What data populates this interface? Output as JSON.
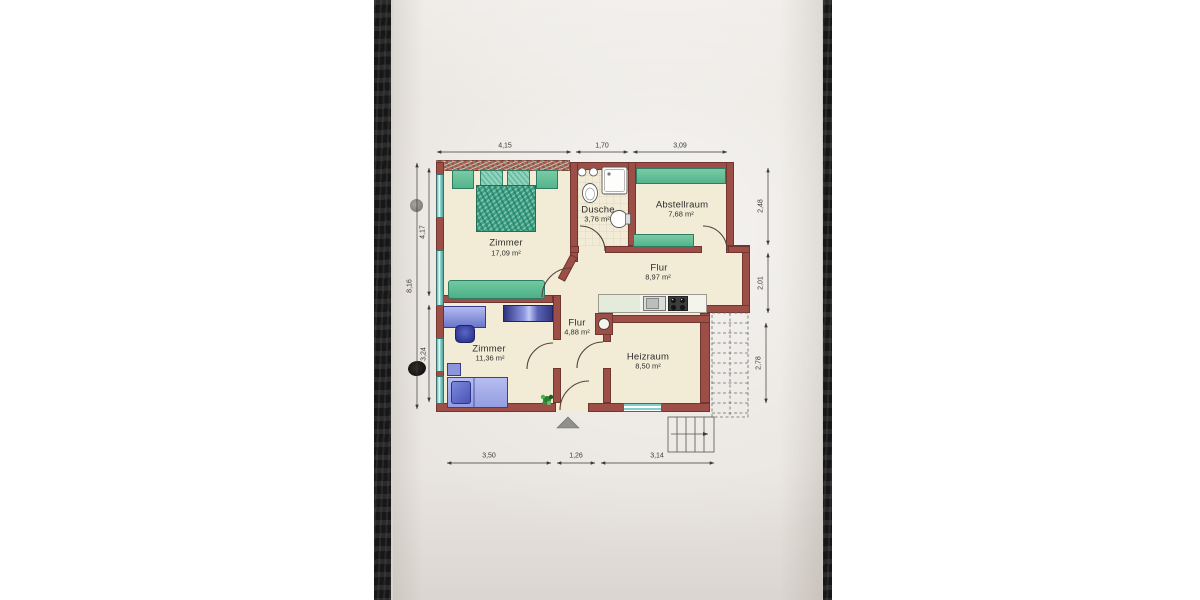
{
  "floorplan": {
    "rooms": [
      {
        "name": "Zimmer",
        "area": "17,09 m²"
      },
      {
        "name": "Dusche",
        "area": "3,76 m²"
      },
      {
        "name": "Abstellraum",
        "area": "7,68 m²"
      },
      {
        "name": "Flur",
        "area": "8,97 m²"
      },
      {
        "name": "Flur",
        "area": "4,88 m²"
      },
      {
        "name": "Zimmer",
        "area": "11,36 m²"
      },
      {
        "name": "Heizraum",
        "area": "8,50 m²"
      }
    ],
    "dimensions": {
      "top": [
        "4,15",
        "1,70",
        "3,09"
      ],
      "right": [
        "2,48",
        "2,01",
        "2,78"
      ],
      "left_outer": [
        "8,16"
      ],
      "left_inner": [
        "4,17",
        "3,24"
      ],
      "bottom": [
        "3,50",
        "1,26",
        "3,14"
      ]
    },
    "colors": {
      "wall_red": "#9d4f47",
      "floor_cream": "#f2ecd6",
      "paper": "#e9e5e0",
      "furniture_green": "#4fae8c",
      "furniture_blue": "#8a93d8",
      "window_teal": "#7fd0c8",
      "photo_edge_black": "#171717",
      "page_background": "#ffffff"
    }
  }
}
